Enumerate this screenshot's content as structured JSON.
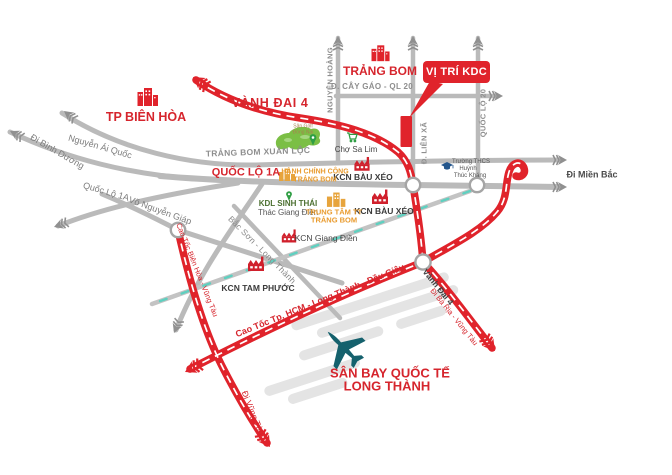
{
  "callout": {
    "label": "VỊ TRÍ KDC"
  },
  "colors": {
    "accent_red": "#e0232b",
    "gray_road": "#bababa",
    "orange": "#e99b2e",
    "plane_teal": "#15616d",
    "green": "#2f9e44",
    "railway_teal": "#5fd0c0"
  },
  "places": {
    "tp_bien_hoa": "TP BIÊN HÒA",
    "trang_bom": "TRẢNG BOM",
    "san_bay_line1": "SÂN BAY QUỐC TẾ",
    "san_bay_line2": "LONG THÀNH",
    "cho_sa_lim": "Chợ Sa Lim",
    "kcn_bau_xeo_1": "KCN BÀU XÉO",
    "kcn_bau_xeo_2": "KCN BÀU XÉO",
    "kcn_giang_dien": "KCN Giang Điền",
    "kcn_tam_phuoc": "KCN TAM PHƯỚC",
    "kdl_line1": "KDL SINH THÁI",
    "kdl_line2": "Thác Giang Điền",
    "hanh_chinh_line1": "HÀNH CHÍNH CÔNG",
    "hanh_chinh_line2": "TRẢNG BOM",
    "trung_tam_line1": "TRUNG TÂM TT",
    "trung_tam_line2": "TRẢNG BOM",
    "truong_thcs_line1": "Trường THCS",
    "truong_thcs_line2": "Huỳnh",
    "truong_thcs_line3": "Thúc Kháng",
    "san_golf_line1": "Sân Golf",
    "san_golf_line2": "Đồng Nai"
  },
  "roads": {
    "nguyen_ai_quoc": "Nguyễn Ái Quốc",
    "di_binh_duong": "Đi Bình Dương",
    "quoc_lo_1a_gray": "Quốc Lộ 1A",
    "quoc_lo_1a_red": "QUỐC LỘ 1A",
    "trang_bom_xuan_loc": "TRẢNG BOM XUÂN LỘC",
    "vanh_dai_4_north": "VÀNH ĐAI 4",
    "cay_gao": "Đ. CÂY GÁO - QL 20",
    "nguyen_hoang": "NGUYỄN HOÀNG",
    "lien_xa": "Đ. LIÊN XÃ",
    "quoc_lo_20": "QUỐC LỘ 20",
    "di_mien_bac": "Đi Miền Bắc",
    "vo_nguyen_giap": "Võ Nguyễn Giáp",
    "bac_son_long_thanh": "Bắc Sơn - Long Thành",
    "cao_toc_bh_vt": "Cao Tốc Biên Hòa - Vũng Tàu",
    "di_vung_tau": "Đi Vũng Tàu",
    "cao_toc_hcm": "Cao Tốc Tp. HCM - Long Thành - Dầu Giây",
    "vanh_dai_4_south": "Vành Đai 4",
    "di_ba_ria": "Đi Bà Rịa - Vũng Tàu"
  }
}
